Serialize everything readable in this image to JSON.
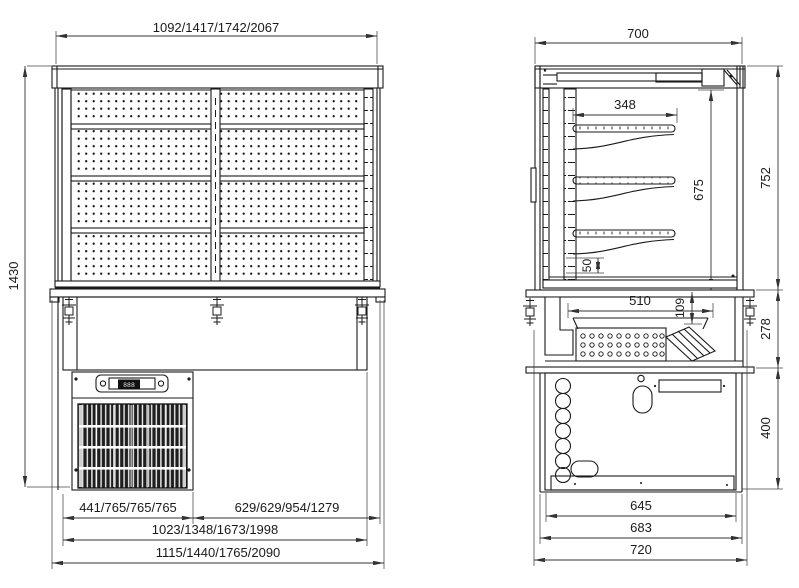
{
  "front_view": {
    "width_options": "1092/1417/1742/2067",
    "height": "1430",
    "cooling_unit_widths": "441/765/765/765",
    "right_section_widths": "629/629/954/1279",
    "inner_widths": "1023/1348/1673/1998",
    "overall_widths": "1115/1440/1765/2090",
    "controller_display": "888"
  },
  "side_view": {
    "depth": "700",
    "shelf_depth": "348",
    "display_opening_height": "675",
    "upper_section_height": "752",
    "shelf_bracket_step": "50",
    "well_width": "510",
    "well_depth": "109",
    "counter_section_height": "278",
    "base_section_height": "400",
    "base_width": "645",
    "frame_width": "683",
    "overall_depth": "720"
  }
}
